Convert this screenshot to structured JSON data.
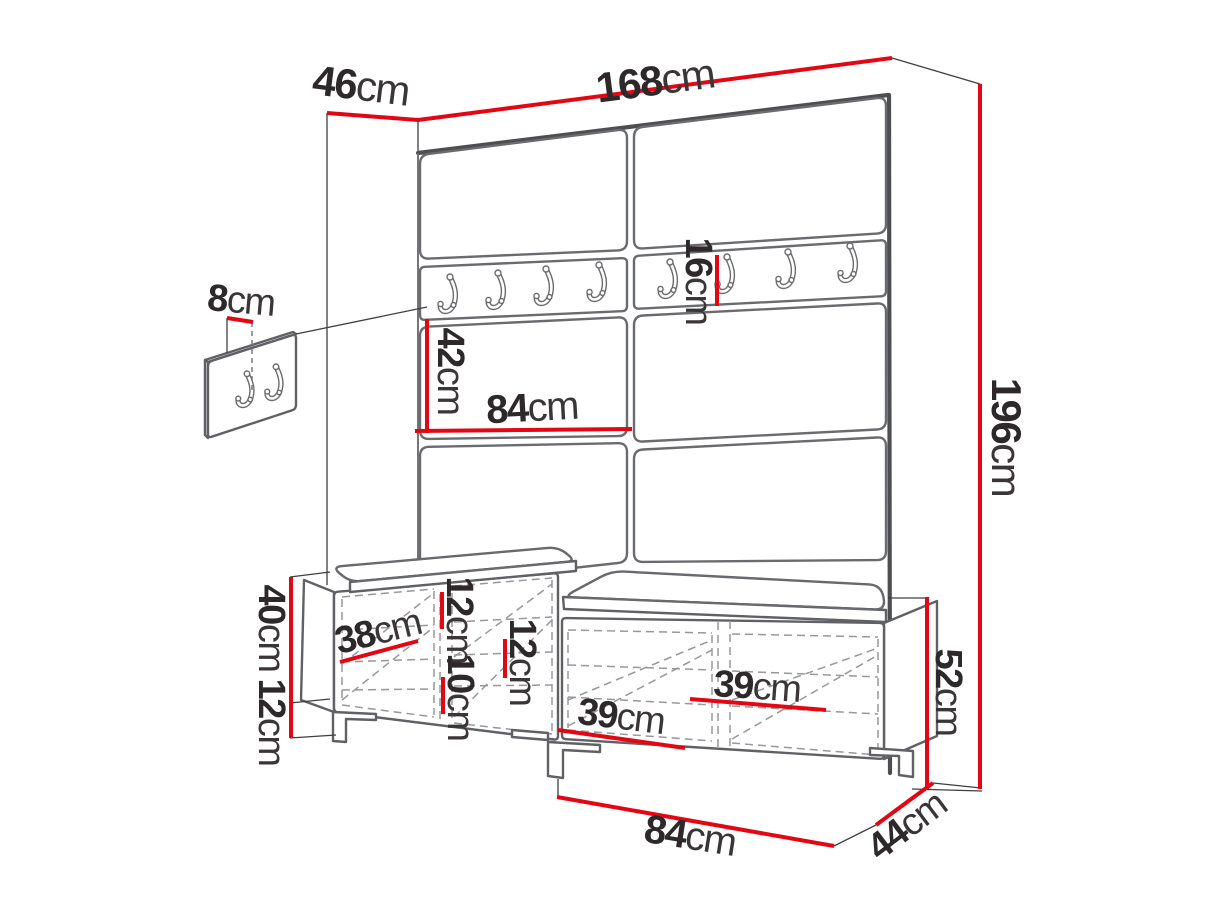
{
  "diagram": {
    "type": "furniture-dimension-diagram",
    "subject": "hallway set: upholstered wall panel with coat hooks and shoe bench with cushions",
    "unit": "cm",
    "colors": {
      "dimension_red": "#e30613",
      "furniture_gray": "#606165",
      "heavy_gray": "#4d4e50",
      "dashed_gray": "#97989b",
      "text_dark": "#2d292a",
      "background": "#ffffff"
    },
    "dimensions": [
      {
        "id": "panel-width",
        "value": "168",
        "unit": "cm",
        "line": [
          418,
          120,
          892,
          58
        ],
        "label": [
          655,
          80
        ],
        "rot": -7.5,
        "size": 42
      },
      {
        "id": "panel-depth",
        "value": "46",
        "unit": "cm",
        "line": [
          327,
          113,
          418,
          120
        ],
        "label": [
          361,
          85
        ],
        "rot": 7,
        "size": 42
      },
      {
        "id": "panel-height",
        "value": "196",
        "unit": "cm",
        "line": [
          980,
          84,
          980,
          789
        ],
        "label": [
          1007,
          437
        ],
        "rot": 90,
        "size": 42
      },
      {
        "id": "hook-rail-height",
        "value": "16",
        "unit": "cm",
        "line": [
          717,
          255,
          717,
          306
        ],
        "label": [
          698,
          281
        ],
        "rot": 90,
        "size": 38
      },
      {
        "id": "upholstered-panel-height",
        "value": "42",
        "unit": "cm",
        "line": [
          427,
          319,
          427,
          433
        ],
        "label": [
          450,
          371
        ],
        "rot": 90,
        "size": 38
      },
      {
        "id": "upholstered-panel-width",
        "value": "84",
        "unit": "cm",
        "line": [
          415,
          431,
          632,
          429
        ],
        "label": [
          532,
          408
        ],
        "rot": -3,
        "size": 40
      },
      {
        "id": "wall-hook-spacing",
        "value": "8",
        "unit": "cm",
        "line": [
          227,
          318,
          253,
          322
        ],
        "label": [
          241,
          301
        ],
        "rot": 5,
        "size": 38
      },
      {
        "id": "bench-body-height",
        "value": "40",
        "unit": "cm",
        "line": [
          291,
          577,
          291,
          703
        ],
        "label": [
          271,
          628
        ],
        "rot": 90,
        "size": 38
      },
      {
        "id": "leg-height",
        "value": "12",
        "unit": "cm",
        "line": [
          291,
          703,
          291,
          738
        ],
        "label": [
          271,
          722
        ],
        "rot": 90,
        "size": 38
      },
      {
        "id": "compartment-width-38",
        "value": "38",
        "unit": "cm",
        "line": [
          340,
          662,
          418,
          641
        ],
        "label": [
          378,
          632
        ],
        "rot": -14,
        "size": 38
      },
      {
        "id": "shelf-spacing-12-left",
        "value": "12",
        "unit": "cm",
        "line": [
          442,
          592,
          442,
          629
        ],
        "label": [
          459,
          620
        ],
        "rot": 90,
        "size": 38
      },
      {
        "id": "shelf-spacing-10",
        "value": "10",
        "unit": "cm",
        "line": [
          443,
          677,
          443,
          714
        ],
        "label": [
          460,
          697
        ],
        "rot": 90,
        "size": 38
      },
      {
        "id": "shelf-spacing-12-center",
        "value": "12",
        "unit": "cm",
        "line": [
          505,
          639,
          505,
          678
        ],
        "label": [
          522,
          662
        ],
        "rot": 90,
        "size": 38
      },
      {
        "id": "compartment-width-39-left",
        "value": "39",
        "unit": "cm",
        "line": [
          558,
          730,
          685,
          748
        ],
        "label": [
          621,
          717
        ],
        "rot": 7,
        "size": 38
      },
      {
        "id": "compartment-width-39-right",
        "value": "39",
        "unit": "cm",
        "line": [
          690,
          699,
          826,
          710
        ],
        "label": [
          757,
          687
        ],
        "rot": 4,
        "size": 38
      },
      {
        "id": "bench-width",
        "value": "84",
        "unit": "cm",
        "line": [
          557,
          797,
          834,
          846
        ],
        "label": [
          690,
          836
        ],
        "rot": 9,
        "size": 40
      },
      {
        "id": "bench-depth",
        "value": "44",
        "unit": "cm",
        "line": [
          876,
          825,
          933,
          783
        ],
        "label": [
          907,
          826
        ],
        "rot": -37,
        "size": 38
      },
      {
        "id": "bench-total-height",
        "value": "52",
        "unit": "cm",
        "line": [
          927,
          597,
          927,
          789
        ],
        "label": [
          948,
          692
        ],
        "rot": 90,
        "size": 38
      }
    ]
  }
}
